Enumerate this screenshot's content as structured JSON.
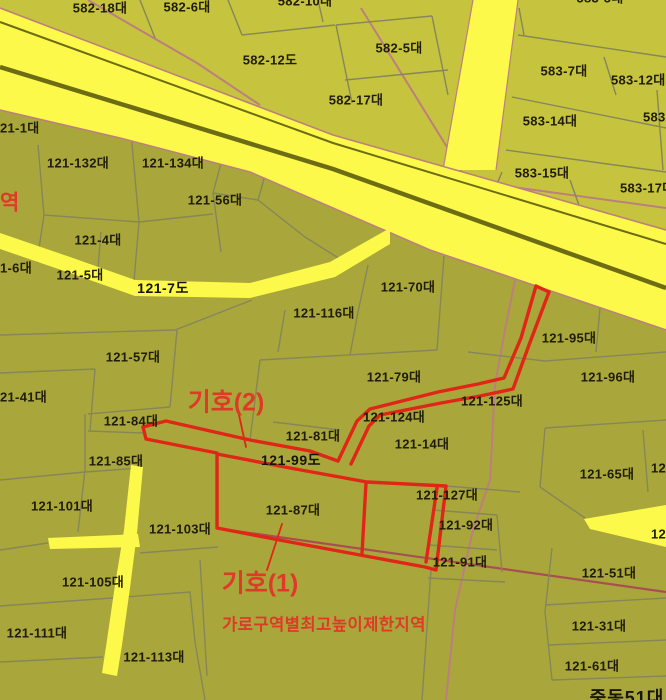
{
  "map": {
    "kind": "korean-cadastral-zoning-map",
    "colors": {
      "background_lower": "#a9a73c",
      "background_upper": "#c6c33e",
      "road_yellow": "#fdf94a",
      "road_stripe_dark": "#6c6c14",
      "parcel_line_grey": "#86865a",
      "district_line_pink": "#bc7f7f",
      "district_line_wine": "#a85050",
      "red_overlay": "#e02617",
      "red_text": "#dd3b28",
      "label_ink": "#201c05"
    },
    "annotations": {
      "symbol1": "기호(1)",
      "symbol2": "기호(2)",
      "restriction_zone": "가로구역별최고높이제한지역",
      "left_edge_zone_fragment": "역"
    },
    "labels": [
      {
        "text": "582-18대",
        "x": 100,
        "y": 8,
        "kind": "parcel"
      },
      {
        "text": "582-6대",
        "x": 187,
        "y": 7,
        "kind": "parcel"
      },
      {
        "text": "582-10대",
        "x": 305,
        "y": 1,
        "kind": "frag"
      },
      {
        "text": "583-5대",
        "x": 600,
        "y": -2,
        "kind": "frag"
      },
      {
        "text": "582-5대",
        "x": 399,
        "y": 48,
        "kind": "parcel"
      },
      {
        "text": "582-12도",
        "x": 270,
        "y": 60,
        "kind": "parcel"
      },
      {
        "text": "582-17대",
        "x": 356,
        "y": 100,
        "kind": "parcel"
      },
      {
        "text": "583-7대",
        "x": 564,
        "y": 71,
        "kind": "parcel"
      },
      {
        "text": "583-12대",
        "x": 611,
        "y": 80,
        "kind": "parcel",
        "anchor": "left"
      },
      {
        "text": "583-14대",
        "x": 550,
        "y": 121,
        "kind": "parcel"
      },
      {
        "text": "583",
        "x": 643,
        "y": 117,
        "kind": "frag",
        "anchor": "left"
      },
      {
        "text": "583-15대",
        "x": 542,
        "y": 173,
        "kind": "parcel"
      },
      {
        "text": "583-17대",
        "x": 620,
        "y": 188,
        "kind": "parcel",
        "anchor": "left"
      },
      {
        "text": "21-1대",
        "x": 0,
        "y": 128,
        "kind": "frag",
        "anchor": "left"
      },
      {
        "text": "역",
        "x": 0,
        "y": 203,
        "kind": "red-frag",
        "anchor": "left"
      },
      {
        "text": "121-132대",
        "x": 78,
        "y": 163,
        "kind": "parcel"
      },
      {
        "text": "121-134대",
        "x": 173,
        "y": 163,
        "kind": "parcel"
      },
      {
        "text": "121-56대",
        "x": 215,
        "y": 200,
        "kind": "parcel"
      },
      {
        "text": "121-4대",
        "x": 98,
        "y": 240,
        "kind": "parcel"
      },
      {
        "text": "1-6대",
        "x": 0,
        "y": 268,
        "kind": "frag",
        "anchor": "left"
      },
      {
        "text": "121-5대",
        "x": 80,
        "y": 275,
        "kind": "parcel"
      },
      {
        "text": "121-7도",
        "x": 163,
        "y": 288,
        "kind": "road"
      },
      {
        "text": "121-70대",
        "x": 408,
        "y": 287,
        "kind": "parcel"
      },
      {
        "text": "121-116대",
        "x": 324,
        "y": 313,
        "kind": "parcel"
      },
      {
        "text": "121-95대",
        "x": 569,
        "y": 338,
        "kind": "parcel"
      },
      {
        "text": "121-57대",
        "x": 133,
        "y": 357,
        "kind": "parcel"
      },
      {
        "text": "121-79대",
        "x": 394,
        "y": 377,
        "kind": "parcel"
      },
      {
        "text": "121-96대",
        "x": 608,
        "y": 377,
        "kind": "parcel"
      },
      {
        "text": "21-41대",
        "x": 0,
        "y": 397,
        "kind": "frag",
        "anchor": "left"
      },
      {
        "text": "기호(2)",
        "x": 226,
        "y": 403,
        "kind": "red-big"
      },
      {
        "text": "121-125대",
        "x": 492,
        "y": 401,
        "kind": "parcel"
      },
      {
        "text": "121-124대",
        "x": 394,
        "y": 417,
        "kind": "parcel"
      },
      {
        "text": "121-84대",
        "x": 131,
        "y": 421,
        "kind": "parcel"
      },
      {
        "text": "121-81대",
        "x": 313,
        "y": 436,
        "kind": "parcel"
      },
      {
        "text": "121-14대",
        "x": 422,
        "y": 444,
        "kind": "parcel"
      },
      {
        "text": "121-99도",
        "x": 291,
        "y": 460,
        "kind": "road"
      },
      {
        "text": "121-85대",
        "x": 116,
        "y": 461,
        "kind": "parcel"
      },
      {
        "text": "121-65대",
        "x": 607,
        "y": 474,
        "kind": "parcel"
      },
      {
        "text": "12",
        "x": 666,
        "y": 468,
        "kind": "frag",
        "anchor": "right"
      },
      {
        "text": "121-101대",
        "x": 62,
        "y": 506,
        "kind": "parcel"
      },
      {
        "text": "121-87대",
        "x": 293,
        "y": 510,
        "kind": "parcel"
      },
      {
        "text": "121-127대",
        "x": 447,
        "y": 495,
        "kind": "parcel"
      },
      {
        "text": "121-103대",
        "x": 180,
        "y": 529,
        "kind": "parcel"
      },
      {
        "text": "121-92대",
        "x": 466,
        "y": 525,
        "kind": "parcel"
      },
      {
        "text": "12",
        "x": 666,
        "y": 534,
        "kind": "frag",
        "anchor": "right"
      },
      {
        "text": "121-91대",
        "x": 460,
        "y": 562,
        "kind": "parcel"
      },
      {
        "text": "121-51대",
        "x": 609,
        "y": 573,
        "kind": "parcel"
      },
      {
        "text": "기호(1)",
        "x": 260,
        "y": 584,
        "kind": "red-big"
      },
      {
        "text": "121-105대",
        "x": 93,
        "y": 582,
        "kind": "parcel"
      },
      {
        "text": "가로구역별최고높이제한지역",
        "x": 324,
        "y": 625,
        "kind": "red-med"
      },
      {
        "text": "121-111대",
        "x": 37,
        "y": 633,
        "kind": "parcel"
      },
      {
        "text": "121-31대",
        "x": 599,
        "y": 626,
        "kind": "parcel"
      },
      {
        "text": "121-113대",
        "x": 154,
        "y": 657,
        "kind": "parcel"
      },
      {
        "text": "121-61대",
        "x": 592,
        "y": 666,
        "kind": "parcel"
      },
      {
        "text": "중동51대",
        "x": 627,
        "y": 698,
        "kind": "dark-big"
      }
    ]
  }
}
